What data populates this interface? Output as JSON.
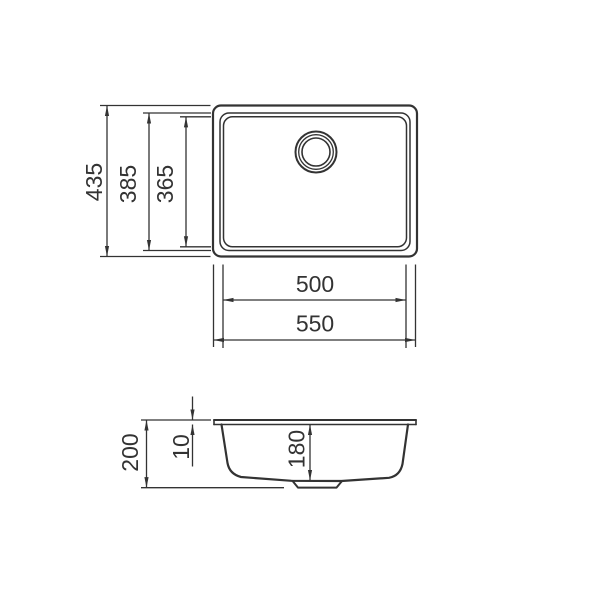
{
  "image": {
    "width": 600,
    "height": 600,
    "background_color": "#ffffff",
    "line_color": "#333333"
  },
  "drawing": {
    "top_view": {
      "overall_height": "435",
      "rim_height": "385",
      "inner_height": "365",
      "inner_width": "500",
      "overall_width": "550"
    },
    "side_view": {
      "overall_depth": "200",
      "rim_thickness": "10",
      "bowl_depth": "180"
    }
  }
}
